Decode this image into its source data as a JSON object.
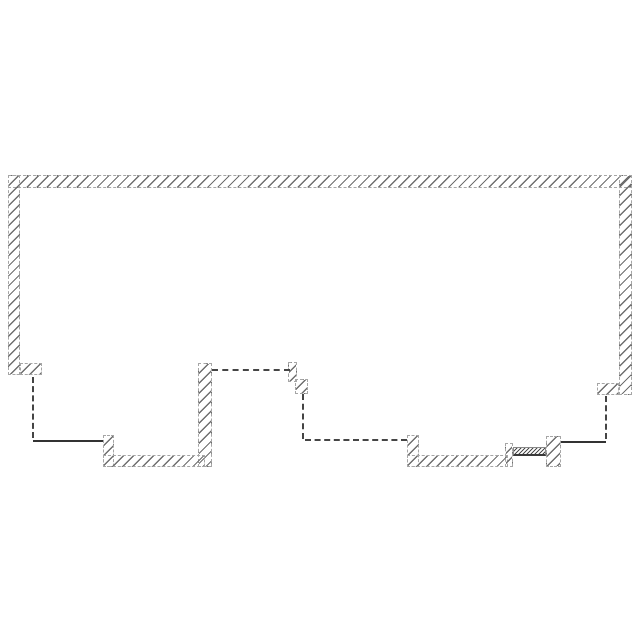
{
  "drawing": {
    "title": "floor-plan-wall-outline",
    "canvas": {
      "width": 640,
      "height": 640,
      "background": "#ffffff"
    },
    "colors": {
      "hatch": "#6e6e6e",
      "fine_hatch": "#4a4a4a",
      "wall_outline": "#a6a6a6",
      "guide_line": "#454545",
      "solid_line": "#333333"
    },
    "walls": [
      {
        "name": "top-wall",
        "x": 8,
        "y": 175,
        "w": 624,
        "h": 13,
        "variant": "coarse"
      },
      {
        "name": "left-wall",
        "x": 8,
        "y": 175,
        "w": 12,
        "h": 200,
        "variant": "coarse"
      },
      {
        "name": "right-wall",
        "x": 619,
        "y": 175,
        "w": 13,
        "h": 220,
        "variant": "coarse"
      },
      {
        "name": "left-wall-stub",
        "x": 20,
        "y": 363,
        "w": 22,
        "h": 12,
        "variant": "coarse"
      },
      {
        "name": "right-wall-stub",
        "x": 597,
        "y": 383,
        "w": 22,
        "h": 12,
        "variant": "coarse"
      },
      {
        "name": "center-pillar",
        "x": 198,
        "y": 363,
        "w": 14,
        "h": 104,
        "variant": "coarse"
      },
      {
        "name": "bottom-left-pier",
        "x": 103,
        "y": 435,
        "w": 11,
        "h": 32,
        "variant": "coarse"
      },
      {
        "name": "bottom-wall-left",
        "x": 103,
        "y": 455,
        "w": 102,
        "h": 12,
        "variant": "coarse"
      },
      {
        "name": "step-jog-upper",
        "x": 288,
        "y": 362,
        "w": 9,
        "h": 20,
        "variant": "coarse"
      },
      {
        "name": "step-jog-lower",
        "x": 295,
        "y": 379,
        "w": 13,
        "h": 15,
        "variant": "coarse"
      },
      {
        "name": "bottom-right-pier-left",
        "x": 407,
        "y": 435,
        "w": 12,
        "h": 32,
        "variant": "coarse"
      },
      {
        "name": "bottom-wall-right",
        "x": 407,
        "y": 455,
        "w": 101,
        "h": 12,
        "variant": "coarse"
      },
      {
        "name": "sill-mini-pier",
        "x": 505,
        "y": 443,
        "w": 8,
        "h": 24,
        "variant": "coarse"
      },
      {
        "name": "door-sill",
        "x": 513,
        "y": 447,
        "w": 33,
        "h": 9,
        "variant": "fine"
      },
      {
        "name": "bottom-right-pier-right",
        "x": 546,
        "y": 436,
        "w": 15,
        "h": 31,
        "variant": "coarse"
      }
    ],
    "lines": [
      {
        "name": "left-guide-vertical",
        "x": 32,
        "y": 377,
        "len": 61,
        "orient": "v",
        "style": "dashed"
      },
      {
        "name": "left-bottom-line",
        "x": 33,
        "y": 440,
        "len": 70,
        "orient": "h",
        "style": "solid"
      },
      {
        "name": "pillar-guide-horizontal",
        "x": 212,
        "y": 369,
        "len": 78,
        "orient": "h",
        "style": "dashed"
      },
      {
        "name": "step-guide-vertical",
        "x": 302,
        "y": 394,
        "len": 45,
        "orient": "v",
        "style": "dashed"
      },
      {
        "name": "center-guide-horizontal",
        "x": 305,
        "y": 439,
        "len": 102,
        "orient": "h",
        "style": "dashed"
      },
      {
        "name": "right-guide-vertical",
        "x": 605,
        "y": 396,
        "len": 43,
        "orient": "v",
        "style": "dashed"
      },
      {
        "name": "right-bottom-line",
        "x": 561,
        "y": 441,
        "len": 45,
        "orient": "h",
        "style": "solid"
      }
    ]
  }
}
